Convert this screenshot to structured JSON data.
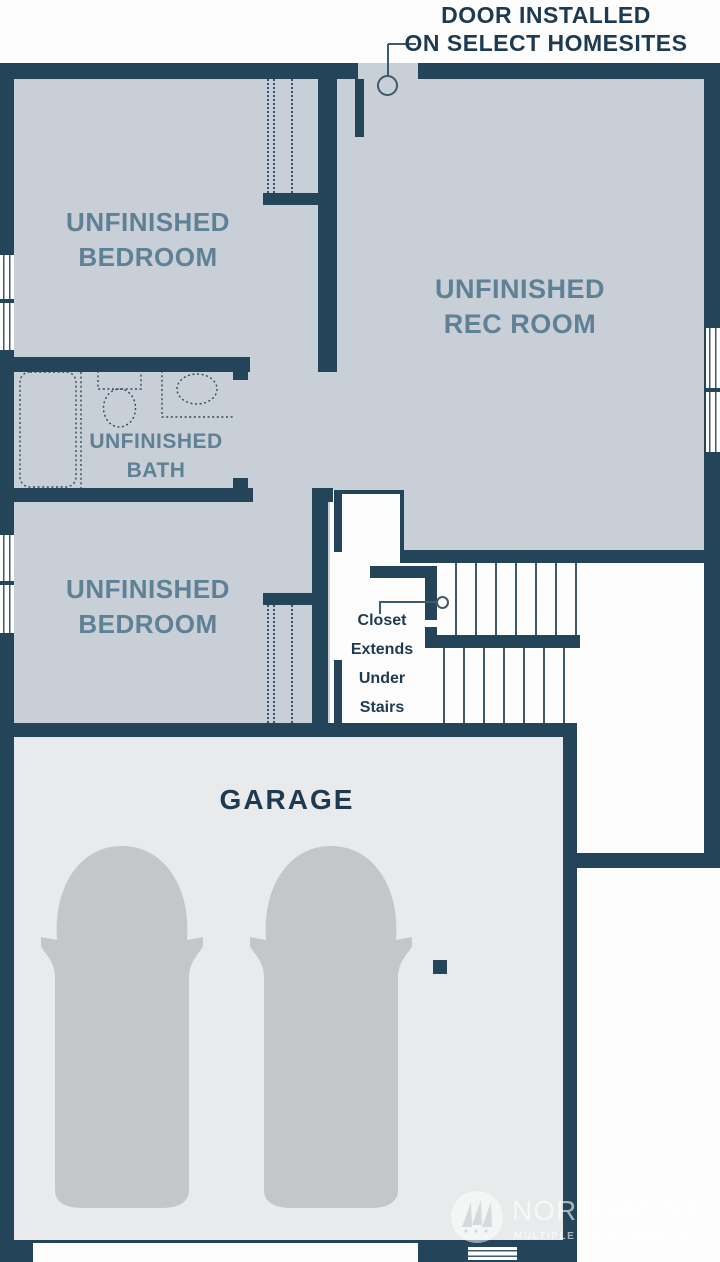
{
  "door_annotation": {
    "line1": "DOOR INSTALLED",
    "line2": "ON SELECT HOMESITES"
  },
  "rooms": {
    "bedroom_top": {
      "line1": "UNFINISHED",
      "line2": "BEDROOM"
    },
    "rec_room": {
      "line1": "UNFINISHED",
      "line2": "REC ROOM"
    },
    "bath": {
      "line1": "UNFINISHED",
      "line2": "BATH"
    },
    "bedroom_bottom": {
      "line1": "UNFINISHED",
      "line2": "BEDROOM"
    },
    "garage": {
      "label": "GARAGE"
    }
  },
  "closet_annotation": {
    "line1": "Closet",
    "line2": "Extends",
    "line3": "Under",
    "line4": "Stairs"
  },
  "watermark": {
    "name": "NORTHWEST",
    "subtitle": "MULTIPLE LISTING SERVICE"
  },
  "colors": {
    "wall": "#234459",
    "room_floor": "#c8cfd6",
    "garage_floor": "#e9eaeb",
    "stair_floor": "#fdfdfe",
    "car": "#c4c6c9",
    "room_label_text": "#5e8196",
    "dark_text": "#1d3a50",
    "thin_line": "#41596c"
  }
}
